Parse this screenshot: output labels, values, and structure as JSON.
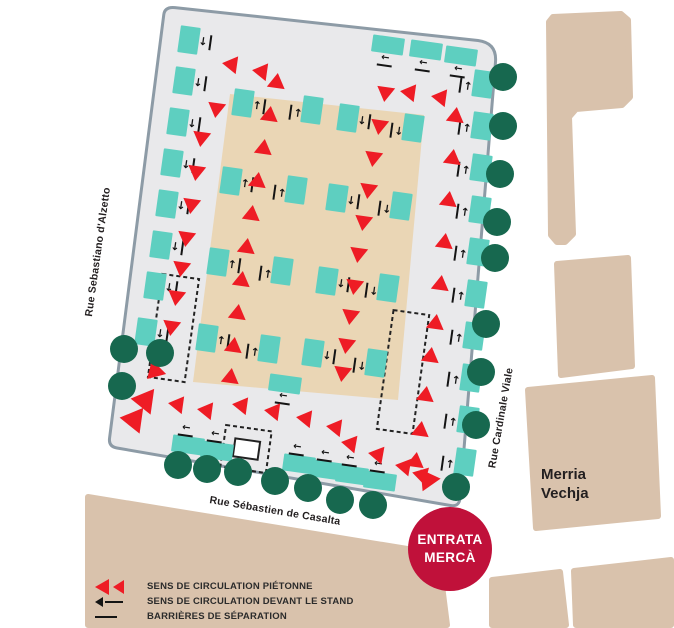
{
  "streets": {
    "left": "Rue Sebastiano d'Alzetto",
    "bottom": "Rue Sébastien de Casalta",
    "right": "Rue Cardinale Viale"
  },
  "places": {
    "building_line1": "Merria",
    "building_line2": "Vechja",
    "entrance_line1": "ENTRATA",
    "entrance_line2": "MERCÀ"
  },
  "legend": {
    "items": [
      {
        "symbol": "red-triangles",
        "label": "SENS DE CIRCULATION PIÉTONNE"
      },
      {
        "symbol": "black-arrow",
        "label": "SENS DE CIRCULATION DEVANT LE STAND"
      },
      {
        "symbol": "black-line",
        "label": "BARRIÈRES DE SÉPARATION"
      }
    ]
  },
  "colors": {
    "stand_teal": "#5ecfc0",
    "flow_red": "#ee1c25",
    "barrier_green": "#17684f",
    "market_gray": "#e9e9eb",
    "market_border": "#8d9ba6",
    "inner_beige": "#ead6b5",
    "building_tan": "#d9c2ac",
    "entrance_red": "#c0113a",
    "text_dark": "#231f20"
  },
  "map_items": {
    "stands": {
      "left_column": [
        [
          189,
          40
        ],
        [
          184,
          81
        ],
        [
          178,
          122
        ],
        [
          172,
          163
        ],
        [
          167,
          204
        ],
        [
          161,
          245
        ],
        [
          155,
          286
        ],
        [
          146,
          332
        ]
      ],
      "top_row": [
        [
          388,
          45
        ],
        [
          426,
          50
        ],
        [
          461,
          56
        ]
      ],
      "right_column": [
        [
          483,
          84
        ],
        [
          482,
          126
        ],
        [
          481,
          168
        ],
        [
          480,
          210
        ],
        [
          478,
          252
        ],
        [
          476,
          294
        ],
        [
          474,
          336
        ],
        [
          471,
          378
        ],
        [
          468,
          420
        ],
        [
          465,
          462
        ]
      ],
      "bottom_row": [
        [
          188,
          445
        ],
        [
          217,
          451
        ],
        [
          299,
          464
        ],
        [
          327,
          470
        ],
        [
          352,
          475
        ],
        [
          380,
          481
        ]
      ],
      "inner_col1": [
        [
          243,
          103
        ],
        [
          231,
          181
        ],
        [
          218,
          262
        ],
        [
          207,
          338
        ]
      ],
      "inner_col2": [
        [
          312,
          110
        ],
        [
          296,
          190
        ],
        [
          282,
          271
        ],
        [
          269,
          349
        ]
      ],
      "inner_col3": [
        [
          348,
          118
        ],
        [
          337,
          198
        ],
        [
          327,
          281
        ],
        [
          313,
          353
        ]
      ],
      "inner_col4": [
        [
          413,
          128
        ],
        [
          401,
          206
        ],
        [
          388,
          288
        ],
        [
          376,
          363
        ]
      ],
      "bottom_center": [
        [
          285,
          384
        ]
      ]
    },
    "flow_arrows": [
      [
        228,
        64,
        188,
        15
      ],
      [
        258,
        71,
        188,
        15
      ],
      [
        216,
        112,
        98,
        15
      ],
      [
        201,
        141,
        98,
        15
      ],
      [
        196,
        175,
        98,
        15
      ],
      [
        191,
        208,
        98,
        15
      ],
      [
        186,
        241,
        98,
        15
      ],
      [
        181,
        271,
        98,
        15
      ],
      [
        176,
        300,
        98,
        15
      ],
      [
        171,
        330,
        98,
        15
      ],
      [
        152,
        374,
        135,
        17
      ],
      [
        140,
        400,
        188,
        22
      ],
      [
        129,
        419,
        188,
        22
      ],
      [
        174,
        404,
        188,
        15
      ],
      [
        203,
        410,
        188,
        15
      ],
      [
        238,
        405,
        188,
        15
      ],
      [
        270,
        411,
        188,
        15
      ],
      [
        302,
        418,
        188,
        15
      ],
      [
        332,
        427,
        188,
        15
      ],
      [
        347,
        443,
        190,
        15
      ],
      [
        374,
        454,
        190,
        15
      ],
      [
        401,
        466,
        190,
        15
      ],
      [
        418,
        474,
        195,
        15
      ],
      [
        426,
        484,
        115,
        19
      ],
      [
        406,
        92,
        188,
        15
      ],
      [
        437,
        97,
        188,
        15
      ],
      [
        456,
        113,
        278,
        15
      ],
      [
        453,
        155,
        278,
        15
      ],
      [
        449,
        197,
        278,
        15
      ],
      [
        445,
        239,
        278,
        15
      ],
      [
        441,
        281,
        278,
        15
      ],
      [
        436,
        320,
        278,
        15
      ],
      [
        431,
        353,
        278,
        15
      ],
      [
        426,
        392,
        278,
        15
      ],
      [
        421,
        427,
        278,
        15
      ],
      [
        416,
        458,
        278,
        15
      ],
      [
        277,
        79,
        278,
        15
      ],
      [
        270,
        112,
        278,
        15
      ],
      [
        264,
        145,
        278,
        15
      ],
      [
        258,
        178,
        278,
        15
      ],
      [
        252,
        211,
        278,
        15
      ],
      [
        247,
        244,
        278,
        15
      ],
      [
        242,
        277,
        278,
        15
      ],
      [
        238,
        310,
        278,
        15
      ],
      [
        234,
        343,
        278,
        15
      ],
      [
        231,
        374,
        278,
        15
      ],
      [
        385,
        96,
        98,
        15
      ],
      [
        379,
        129,
        98,
        15
      ],
      [
        373,
        161,
        98,
        15
      ],
      [
        368,
        193,
        98,
        15
      ],
      [
        363,
        225,
        98,
        15
      ],
      [
        358,
        257,
        98,
        15
      ],
      [
        354,
        289,
        98,
        15
      ],
      [
        350,
        319,
        98,
        15
      ],
      [
        346,
        348,
        98,
        15
      ],
      [
        342,
        376,
        98,
        15
      ]
    ],
    "barrier_circles": [
      [
        503,
        77
      ],
      [
        503,
        126
      ],
      [
        500,
        174
      ],
      [
        497,
        222
      ],
      [
        495,
        258
      ],
      [
        486,
        324
      ],
      [
        481,
        372
      ],
      [
        476,
        425
      ],
      [
        456,
        487
      ],
      [
        178,
        465
      ],
      [
        207,
        469
      ],
      [
        238,
        472
      ],
      [
        275,
        481
      ],
      [
        308,
        488
      ],
      [
        340,
        500
      ],
      [
        373,
        505
      ],
      [
        124,
        349
      ],
      [
        160,
        353
      ],
      [
        122,
        386
      ]
    ]
  }
}
